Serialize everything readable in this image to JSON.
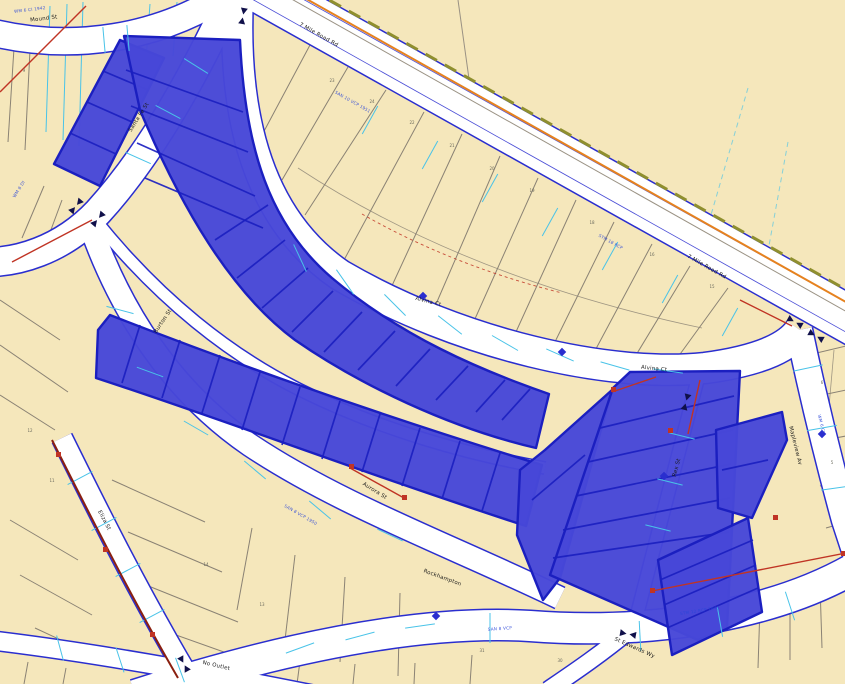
{
  "map": {
    "street_labels": [
      {
        "text": "Mound St"
      },
      {
        "text": "Santa Fe St"
      },
      {
        "text": "7 Mile Road Rd"
      },
      {
        "text": "7 Mile Road Rd"
      },
      {
        "text": "Alvina Ct"
      },
      {
        "text": "Alvina Ct"
      },
      {
        "text": "Burton St"
      },
      {
        "text": "Aurora St"
      },
      {
        "text": "Eliza St"
      },
      {
        "text": "Rockhampton"
      },
      {
        "text": "No Outlet"
      },
      {
        "text": "St Edwards Wy"
      },
      {
        "text": "Rex St"
      },
      {
        "text": "Mapleview Av"
      }
    ],
    "utility_notes": [
      "WM 6 CI 1942",
      "SAN 10 VCP 1951",
      "STM 18 RCP",
      "WM 8 DI",
      "SAN 8 VCP 1950",
      "STM 12 RCP 1949",
      "WM 6 CI",
      "SAN 8 VCP"
    ],
    "parcel_numbers": [
      "23",
      "24",
      "22",
      "21",
      "20",
      "19",
      "18",
      "16",
      "15",
      "12",
      "11",
      "14",
      "13",
      "9",
      "6",
      "5",
      "31",
      "30"
    ]
  },
  "colors": {
    "parcel-fill": "#f5e7bb",
    "parcel-line": "#8a8274",
    "street-edge": "#2a2ecf",
    "selection-fill": "#4747d8",
    "selection-line": "#1b1fc0",
    "cyan": "#49c3e8",
    "red": "#c03424",
    "dark-red": "#8a2010",
    "olive": "#8f8f2e",
    "orange": "#e6821e",
    "note-blue": "#2b46d8",
    "label": "#1a1a1a",
    "number": "#6b6b5e"
  }
}
